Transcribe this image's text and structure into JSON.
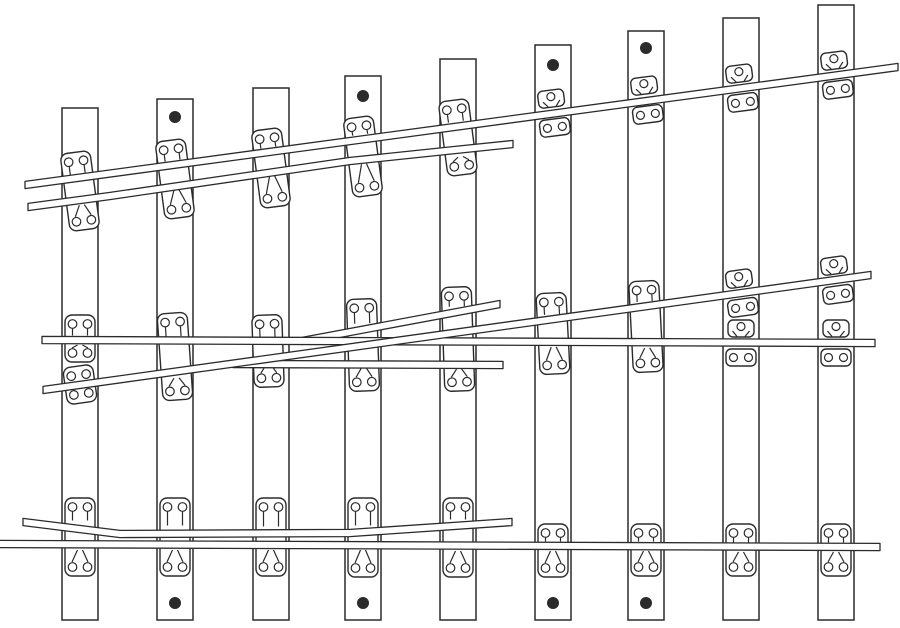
{
  "figure": {
    "canvas": {
      "width": 900,
      "height": 628,
      "background": "#ffffff",
      "line_color": "#2b2b2b",
      "rail_width": 7.2,
      "sleeper_width": 36,
      "sleeper_bottom": 620,
      "dot_radius": 6
    },
    "sleepers": [
      {
        "x": 62,
        "top": 108
      },
      {
        "x": 157,
        "top": 99
      },
      {
        "x": 253,
        "top": 88
      },
      {
        "x": 345,
        "top": 76
      },
      {
        "x": 440,
        "top": 59
      },
      {
        "x": 535,
        "top": 45
      },
      {
        "x": 628,
        "top": 31
      },
      {
        "x": 723,
        "top": 18
      },
      {
        "x": 818,
        "top": 5
      }
    ],
    "plates": [
      {
        "kind": "tall",
        "cx": 80,
        "y0": 152,
        "y1": 230,
        "rails": [
          178,
          200
        ],
        "tilt": -7.5
      },
      {
        "kind": "tall",
        "cx": 175,
        "y0": 140,
        "y1": 218,
        "rails": [
          165,
          185
        ],
        "tilt": -7.5
      },
      {
        "kind": "tall",
        "cx": 271,
        "y0": 129,
        "y1": 207,
        "rails": [
          152,
          171
        ],
        "tilt": -7.5
      },
      {
        "kind": "tall",
        "cx": 363,
        "y0": 117,
        "y1": 196,
        "rails": [
          139,
          159
        ],
        "tilt": -7.5
      },
      {
        "kind": "tall",
        "cx": 458,
        "y0": 100,
        "y1": 175,
        "rails": [
          126,
          152
        ],
        "tilt": -7.5
      },
      {
        "kind": "split",
        "cx": 553,
        "rail": 113,
        "tilt": -7.5
      },
      {
        "kind": "split",
        "cx": 646,
        "rail": 100,
        "tilt": -7.5
      },
      {
        "kind": "split",
        "cx": 741,
        "rail": 88,
        "tilt": -7.5
      },
      {
        "kind": "split",
        "cx": 836,
        "rail": 75,
        "tilt": -7.5
      },
      {
        "kind": "tall",
        "cx": 80,
        "y0": 315,
        "y1": 362,
        "rails": [
          340
        ],
        "tilt": 0
      },
      {
        "kind": "tall",
        "cx": 80,
        "y0": 366,
        "y1": 403,
        "rails": [
          386
        ],
        "tilt": -8
      },
      {
        "kind": "tall",
        "cx": 175,
        "y0": 313,
        "y1": 400,
        "rails": [
          341,
          373
        ],
        "tilt": -4
      },
      {
        "kind": "tall",
        "cx": 268,
        "y0": 315,
        "y1": 387,
        "rails": [
          342,
          360
        ],
        "tilt": -2
      },
      {
        "kind": "tall",
        "cx": 363,
        "y0": 299,
        "y1": 391,
        "rails": [
          328,
          344,
          363
        ],
        "tilt": -2
      },
      {
        "kind": "tall",
        "cx": 458,
        "y0": 287,
        "y1": 391,
        "rails": [
          311,
          333,
          343,
          364
        ],
        "tilt": -2
      },
      {
        "kind": "tall",
        "cx": 553,
        "y0": 293,
        "y1": 374,
        "rails": [
          319,
          342
        ],
        "tilt": -3
      },
      {
        "kind": "tall",
        "cx": 646,
        "y0": 281,
        "y1": 372,
        "rails": [
          306,
          343
        ],
        "tilt": -3
      },
      {
        "kind": "split",
        "cx": 741,
        "rail": 293,
        "tilt": -8
      },
      {
        "kind": "split",
        "cx": 741,
        "rail": 343,
        "tilt": 0
      },
      {
        "kind": "split",
        "cx": 836,
        "rail": 280,
        "tilt": -8
      },
      {
        "kind": "split",
        "cx": 836,
        "rail": 343,
        "tilt": 0
      },
      {
        "kind": "tall",
        "cx": 80,
        "y0": 498,
        "y1": 576,
        "rails": [
          525,
          545
        ],
        "tilt": 0
      },
      {
        "kind": "tall",
        "cx": 175,
        "y0": 498,
        "y1": 576,
        "rails": [
          530,
          545
        ],
        "tilt": 0
      },
      {
        "kind": "tall",
        "cx": 271,
        "y0": 498,
        "y1": 576,
        "rails": [
          531,
          545
        ],
        "tilt": 0
      },
      {
        "kind": "tall",
        "cx": 363,
        "y0": 498,
        "y1": 577,
        "rails": [
          530,
          545
        ],
        "tilt": 0
      },
      {
        "kind": "tall",
        "cx": 458,
        "y0": 498,
        "y1": 577,
        "rails": [
          524,
          546
        ],
        "tilt": 0
      },
      {
        "kind": "tall",
        "cx": 553,
        "y0": 524,
        "y1": 577,
        "rails": [
          546
        ],
        "tilt": 0
      },
      {
        "kind": "tall",
        "cx": 646,
        "y0": 524,
        "y1": 576,
        "rails": [
          546
        ],
        "tilt": 0
      },
      {
        "kind": "tall",
        "cx": 741,
        "y0": 524,
        "y1": 576,
        "rails": [
          547
        ],
        "tilt": 0
      },
      {
        "kind": "tall",
        "cx": 836,
        "y0": 524,
        "y1": 576,
        "rails": [
          547
        ],
        "tilt": 0
      }
    ],
    "rails": [
      {
        "name": "frog-wing-rail-diverging",
        "points": [
          [
            302,
            341
          ],
          [
            500,
            304
          ]
        ]
      },
      {
        "name": "frog-wing-rail-straight",
        "points": [
          [
            233,
            364
          ],
          [
            503,
            365
          ]
        ]
      },
      {
        "name": "straight-running-rail",
        "points": [
          [
            42,
            340
          ],
          [
            875,
            343
          ]
        ]
      },
      {
        "name": "diverging-running-rail",
        "points": [
          [
            43,
            390
          ],
          [
            871,
            275
          ]
        ]
      },
      {
        "name": "diverging-check-rail",
        "points": [
          [
            28,
            207
          ],
          [
            110,
            196
          ],
          [
            350,
            161
          ],
          [
            455,
            150
          ],
          [
            513,
            144
          ]
        ]
      },
      {
        "name": "diverging-stock-rail",
        "points": [
          [
            25,
            185
          ],
          [
            898,
            67
          ]
        ]
      },
      {
        "name": "straight-check-rail",
        "points": [
          [
            23,
            522
          ],
          [
            120,
            534
          ],
          [
            350,
            533
          ],
          [
            512,
            522
          ]
        ]
      },
      {
        "name": "straight-stock-rail",
        "points": [
          [
            -3,
            544
          ],
          [
            880,
            547
          ]
        ]
      }
    ],
    "dots": [
      [
        175,
        117
      ],
      [
        363,
        96
      ],
      [
        553,
        65
      ],
      [
        646,
        48
      ],
      [
        175,
        603
      ],
      [
        363,
        603
      ],
      [
        553,
        603
      ],
      [
        646,
        603
      ]
    ]
  }
}
